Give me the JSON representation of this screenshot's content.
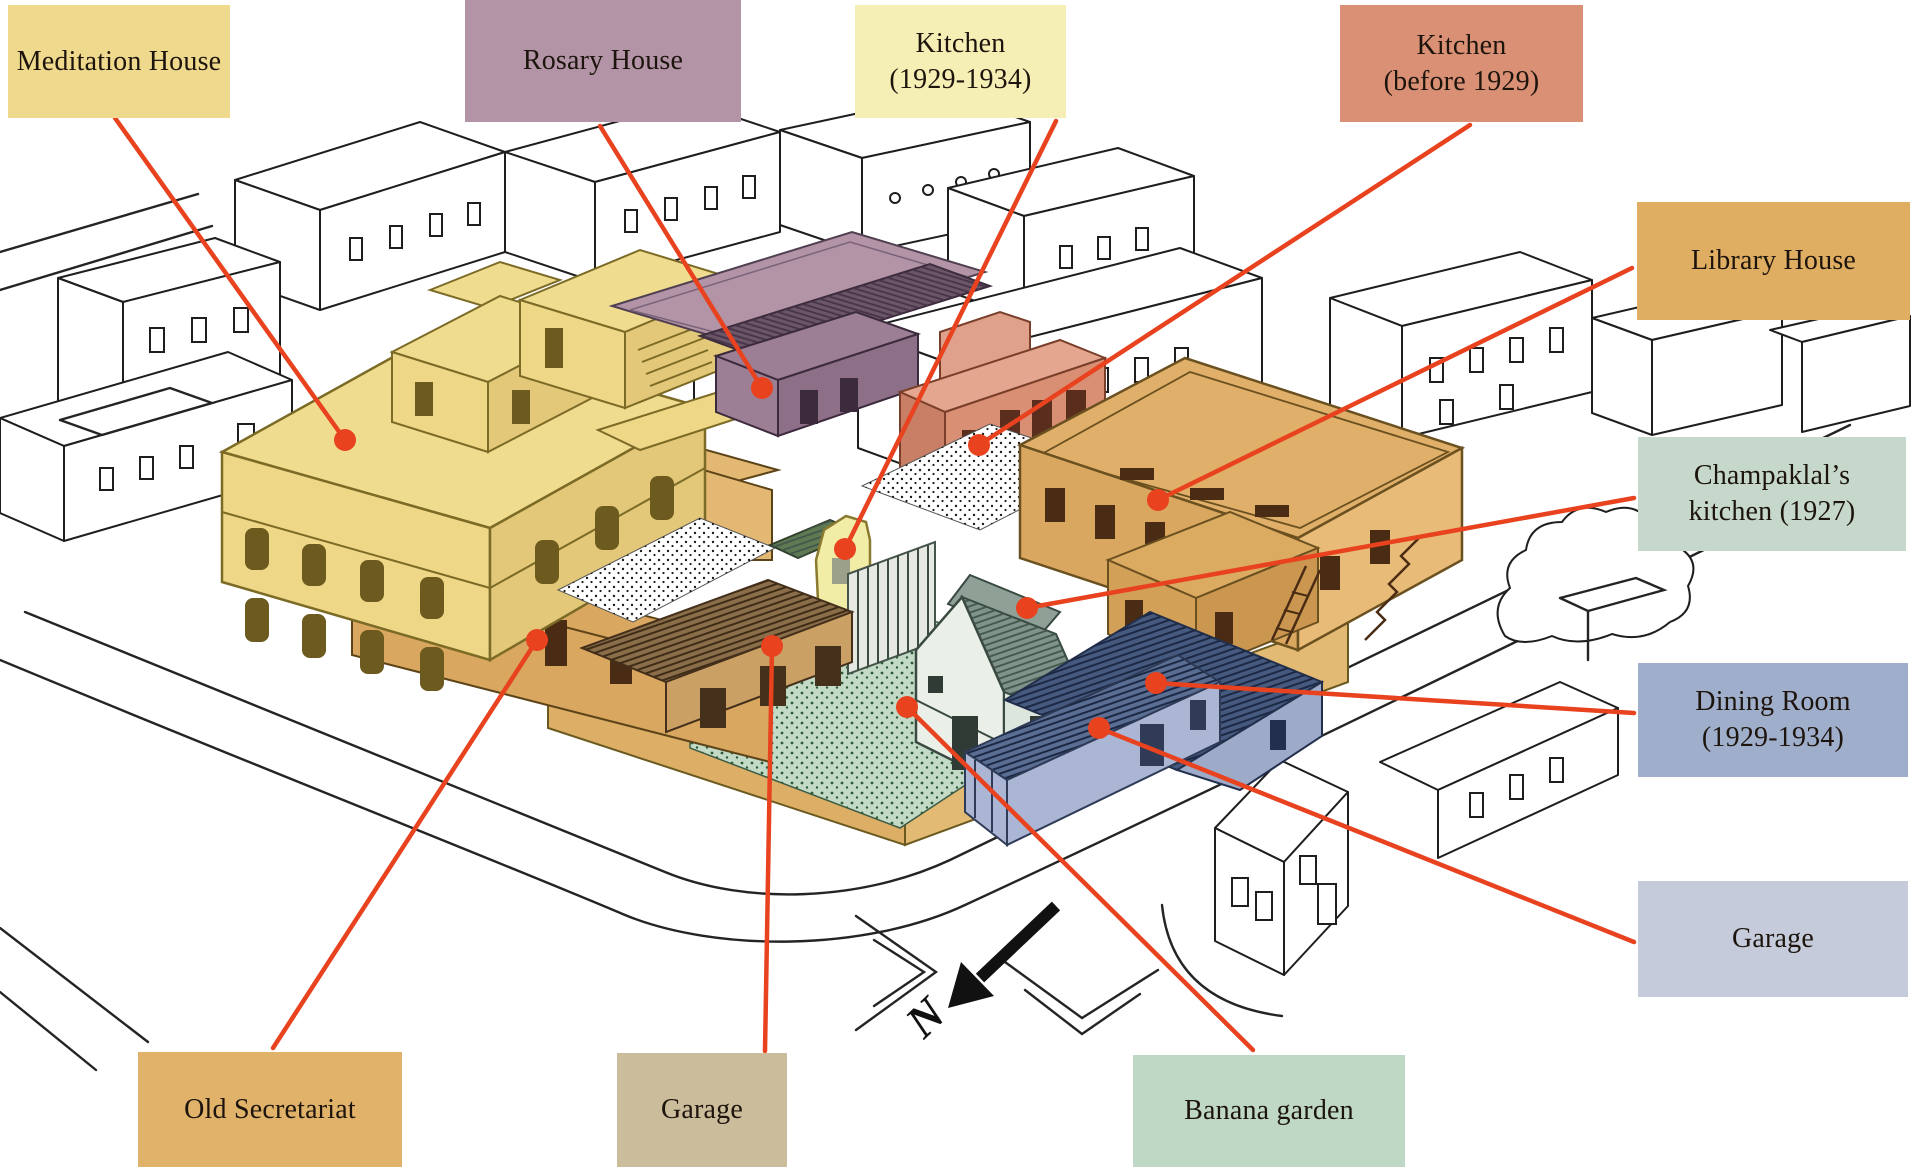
{
  "figure": {
    "description": "Isometric site plan of an ashram block with colour-coded buildings and red leader lines",
    "compass": {
      "letter": "N"
    }
  },
  "labels": [
    {
      "id": "meditation-house",
      "text": "Meditation House",
      "color": "#efd98d"
    },
    {
      "id": "rosary-house",
      "text": "Rosary House",
      "color": "#b394a7"
    },
    {
      "id": "kitchen-1929-1934",
      "text": "Kitchen\n(1929-1934)",
      "color": "#f5efb5"
    },
    {
      "id": "kitchen-before-1929",
      "text": "Kitchen\n(before 1929)",
      "color": "#d99075"
    },
    {
      "id": "library-house",
      "text": "Library House",
      "color": "#dfae62"
    },
    {
      "id": "champaklals-kitchen",
      "text": "Champaklal’s\nkitchen (1927)",
      "color": "#c5d8cb"
    },
    {
      "id": "dining-room",
      "text": "Dining Room\n(1929-1934)",
      "color": "#9faecb"
    },
    {
      "id": "garage-east",
      "text": "Garage",
      "color": "#c5cbdb"
    },
    {
      "id": "old-secretariat",
      "text": "Old Secretariat",
      "color": "#e0b26a"
    },
    {
      "id": "garage-south",
      "text": "Garage",
      "color": "#cbbc9c"
    },
    {
      "id": "banana-garden",
      "text": "Banana garden",
      "color": "#bfd8c5"
    }
  ],
  "palette": {
    "leader_red": "#e8421f",
    "meditation_yellow": "#f0dc8f",
    "rosary_purple": "#b294a6",
    "kitchen_pale_yellow": "#f2eda6",
    "kitchen_salmon": "#d98f74",
    "library_tan": "#e0b06a",
    "secretariat_tan": "#d9a75f",
    "garden_green": "#c3dbc6",
    "champaklal_white_green": "#eaf0e8",
    "dining_blue": "#46597e",
    "garage_blue": "#aab6d4",
    "garage_wood_brown": "#8a6d49",
    "line_art": "#1e1e1e"
  }
}
